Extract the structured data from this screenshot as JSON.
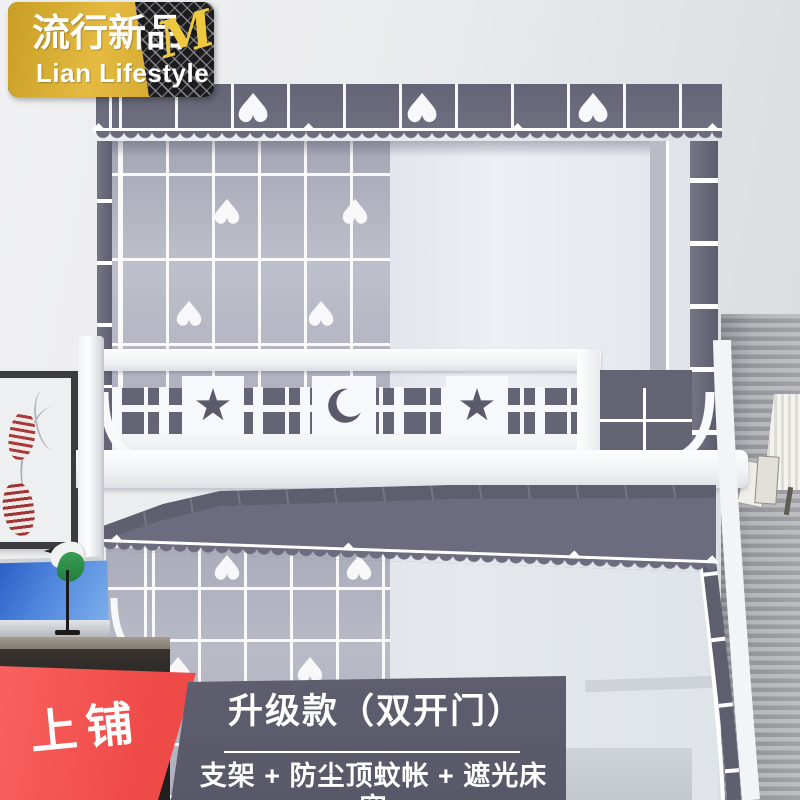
{
  "badge": {
    "brand_cn": "流行新品",
    "brand_script": "Me",
    "brand_en": "Lian Lifestyle",
    "gold_color": "#d9a92e",
    "mesh_color": "#1c1c1e",
    "script_color": "#eec93f"
  },
  "corner_label": {
    "text": "上铺",
    "color": "#f2514e"
  },
  "banner": {
    "title": "升级款（双开门）",
    "subtitle": "支架 + 防尘顶蚊帐 + 遮光床帘",
    "bg_color": "#5b5b6c"
  },
  "decor": {
    "heart_glyph": "♥",
    "star_glyph": "★",
    "diamond_glyph": "◆",
    "moon_icon": "crescent-moon",
    "fabric_slate": "#6b6b7d",
    "grid_gray": "#b3b5c1",
    "sheer_white": "#e6e9ef",
    "frame_white": "#f4f6f8"
  }
}
